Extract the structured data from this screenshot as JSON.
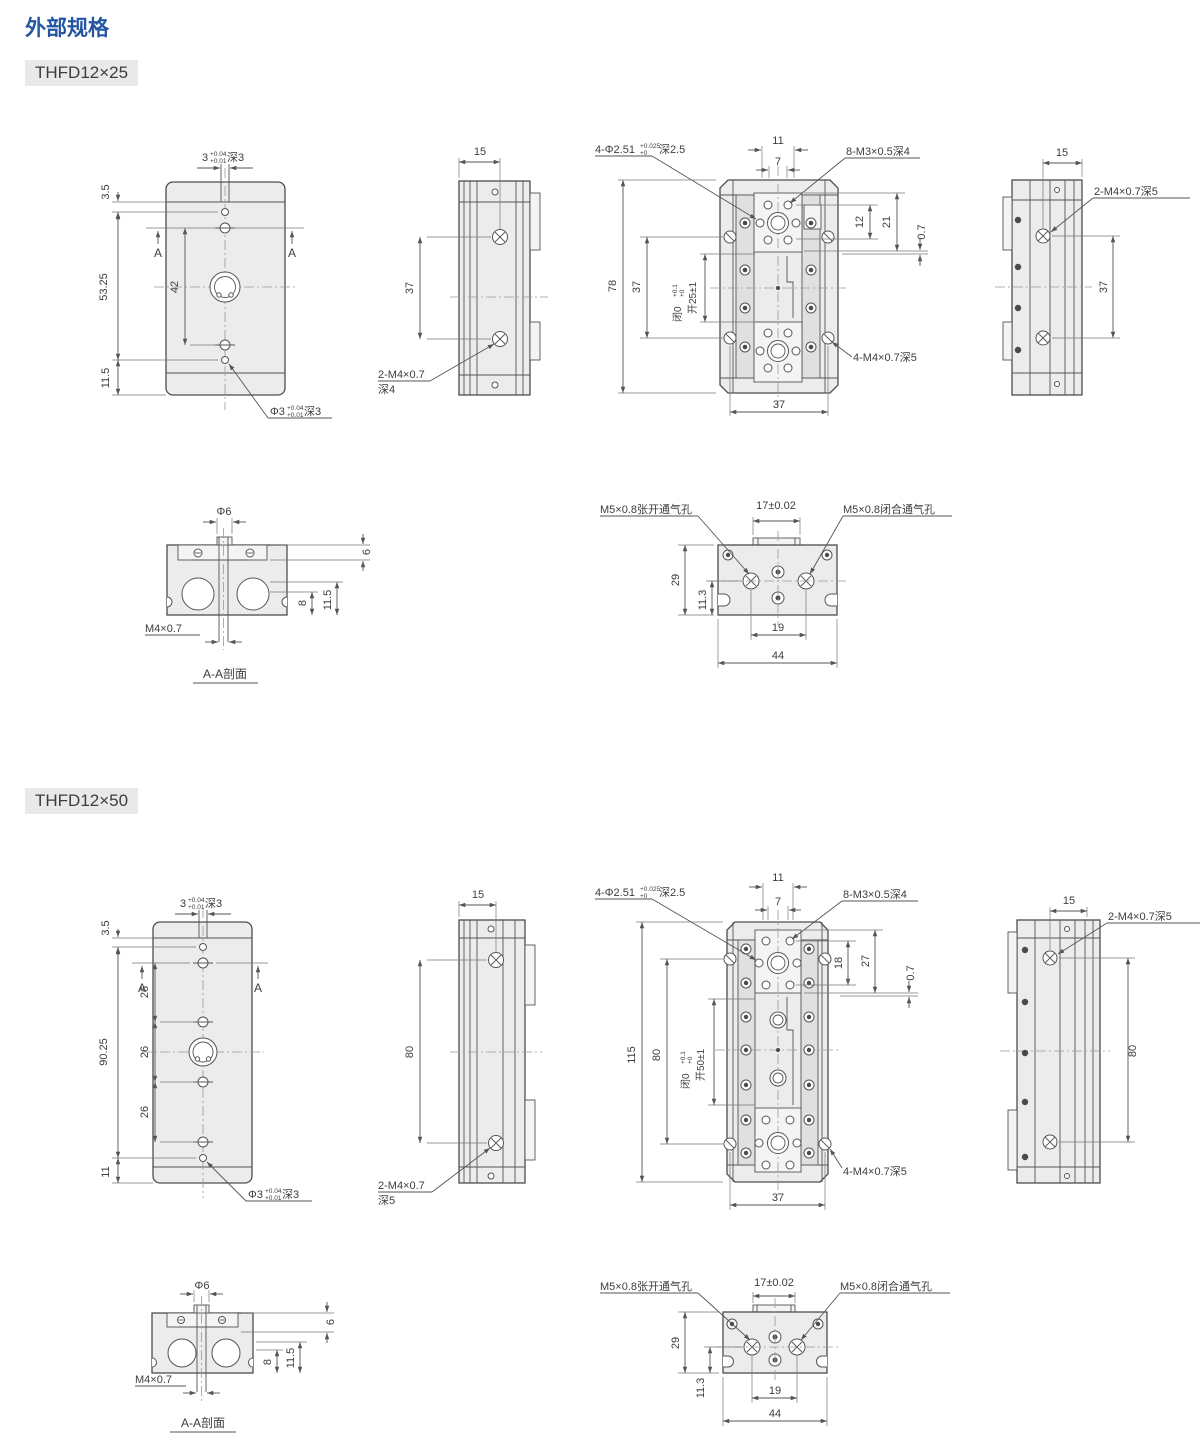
{
  "page": {
    "title": "外部规格"
  },
  "sections": [
    {
      "badge": "THFD12×25",
      "front": {
        "slot": "3",
        "slot_tol_u": "+0.04",
        "slot_tol_l": "+0.01",
        "slot_depth": "深3",
        "top_offset": "3.5",
        "total": "53.25",
        "pitch": "42",
        "bottom_offset": "11.5",
        "sec_mark": "A",
        "hole": "Φ3",
        "hole_tol_u": "+0.04",
        "hole_tol_l": "+0.01",
        "hole_depth": "深3"
      },
      "side": {
        "width": "15",
        "pitch": "37",
        "thread": "2-M4×0.7",
        "thread_depth": "深4"
      },
      "top": {
        "d11": "11",
        "d7": "7",
        "dowel": "4-Φ2.51",
        "dowel_tol_u": "+0.025",
        "dowel_tol_l": "+0",
        "dowel_depth": "深2.5",
        "m3": "8-M3×0.5深4",
        "d12": "12",
        "d21": "21",
        "d07": "0.7",
        "height": "78",
        "pitch": "37",
        "close_label": "闭0",
        "close_tol_u": "+0.1",
        "close_tol_l": "+0",
        "open_label": "开25±1",
        "width": "37",
        "m4": "4-M4×0.7深5"
      },
      "right": {
        "width": "15",
        "thread": "2-M4×0.7深5",
        "pitch": "37"
      },
      "aa": {
        "dia": "Φ6",
        "d6": "6",
        "d8": "8",
        "d115": "11.5",
        "thread": "M4×0.7",
        "caption": "A-A剖面"
      },
      "bottom": {
        "open_port": "M5×0.8张开通气孔",
        "width_tol": "17±0.02",
        "close_port": "M5×0.8闭合通气孔",
        "d29": "29",
        "d113": "11.3",
        "d19": "19",
        "d44": "44"
      }
    },
    {
      "badge": "THFD12×50",
      "front": {
        "slot": "3",
        "slot_tol_u": "+0.04",
        "slot_tol_l": "+0.01",
        "slot_depth": "深3",
        "top_offset": "3.5",
        "total": "90.25",
        "pitch1": "26",
        "pitch2": "26",
        "pitch3": "26",
        "bottom_offset": "11",
        "sec_mark": "A",
        "hole": "Φ3",
        "hole_tol_u": "+0.04",
        "hole_tol_l": "+0.01",
        "hole_depth": "深3"
      },
      "side": {
        "width": "15",
        "pitch": "80",
        "thread": "2-M4×0.7",
        "thread_depth": "深5"
      },
      "top": {
        "d11": "11",
        "d7": "7",
        "dowel": "4-Φ2.51",
        "dowel_tol_u": "+0.025",
        "dowel_tol_l": "+0",
        "dowel_depth": "深2.5",
        "m3": "8-M3×0.5深4",
        "d18": "18",
        "d27": "27",
        "d07": "0.7",
        "height": "115",
        "pitch": "80",
        "close_label": "闭0",
        "close_tol_u": "+0.1",
        "close_tol_l": "+0",
        "open_label": "开50±1",
        "width": "37",
        "m4": "4-M4×0.7深5"
      },
      "right": {
        "width": "15",
        "thread": "2-M4×0.7深5",
        "pitch": "80"
      },
      "aa": {
        "dia": "Φ6",
        "d6": "6",
        "d8": "8",
        "d115": "11.5",
        "thread": "M4×0.7",
        "caption": "A-A剖面"
      },
      "bottom": {
        "open_port": "M5×0.8张开通气孔",
        "width_tol": "17±0.02",
        "close_port": "M5×0.8闭合通气孔",
        "d29": "29",
        "d113": "11.3",
        "d19": "19",
        "d44": "44"
      }
    }
  ]
}
